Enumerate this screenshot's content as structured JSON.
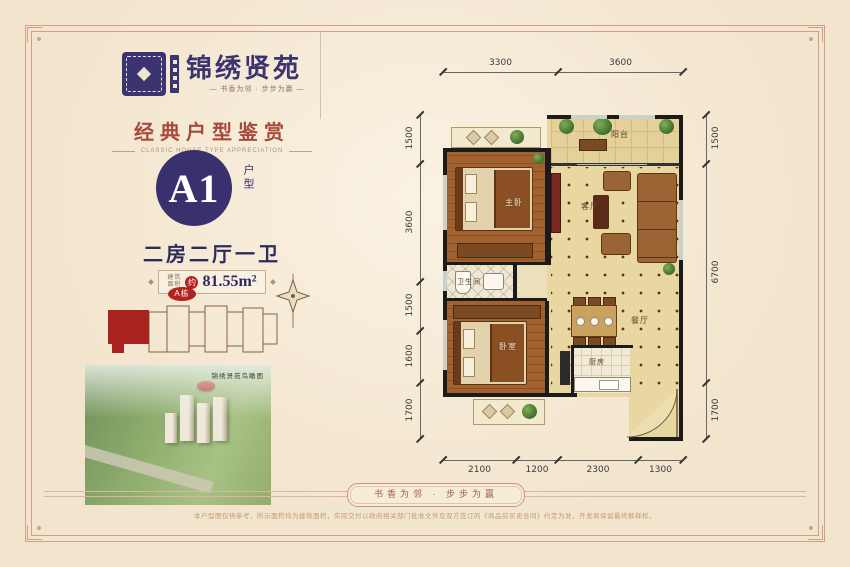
{
  "brand": {
    "name": "锦绣贤苑",
    "tagline": "—  书香为邻 · 步步为赢  —"
  },
  "section": {
    "title": "经典户型鉴赏",
    "subtitle": "CLASSIC HOUSE TYPE APPRECIATION"
  },
  "unit": {
    "code": "A1",
    "code_label": "户型",
    "layout": "二房二厅一卫",
    "area_label_1": "建筑",
    "area_label_2": "面积",
    "area_prefix": "约",
    "area_value": "81.55m²"
  },
  "siteplan": {
    "building_label": "A栋"
  },
  "photo": {
    "caption": "锦绣贤苑鸟瞰图"
  },
  "floorplan": {
    "rooms": {
      "balcony": "阳台",
      "master": "主卧",
      "living": "客厅",
      "bath": "卫生间",
      "bedroom": "卧室",
      "dining": "餐厅",
      "kitchen": "厨房"
    },
    "dims_top": [
      "3300",
      "3600"
    ],
    "dims_left": [
      "1500",
      "3600",
      "1500",
      "1600",
      "1700"
    ],
    "dims_right": [
      "1500",
      "6700",
      "1700"
    ],
    "dims_bottom": [
      "2100",
      "1200",
      "2300",
      "1300"
    ]
  },
  "footer": {
    "ribbon": "书香为邻 · 步步为赢",
    "disclaimer": "本户型图仅供参考，所示面积均为建筑面积，实际交付以政府相关部门批准文件及双方签订的《商品房买卖合同》约定为准，开发商保留最终解释权。"
  },
  "colors": {
    "navy": "#39316e",
    "red": "#b3221f",
    "frame": "#cf9f8c",
    "heading": "#a64b3c"
  }
}
